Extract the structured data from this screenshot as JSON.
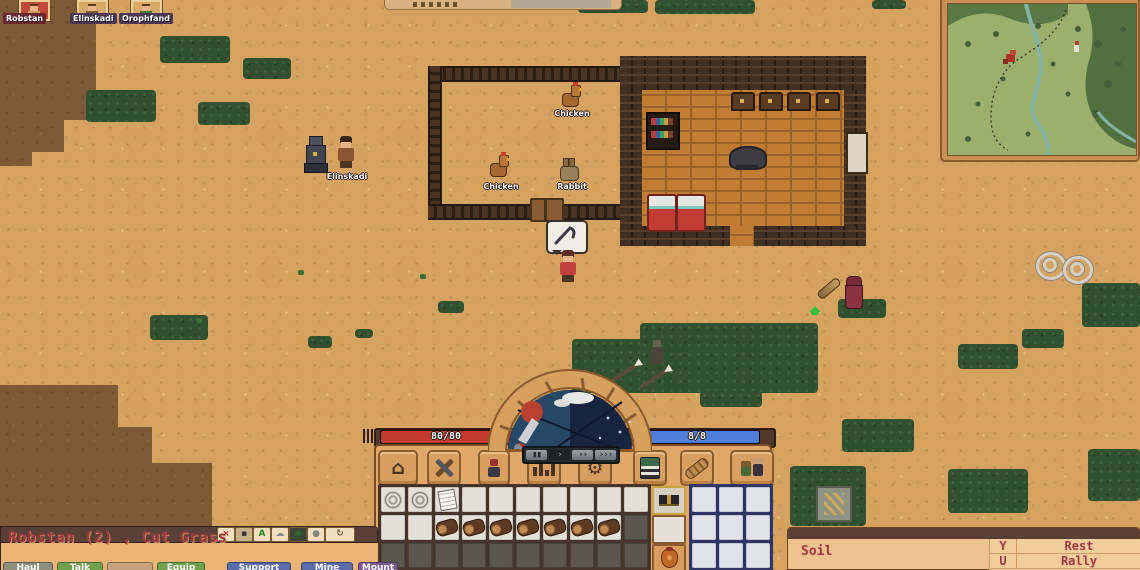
{
  "party": {
    "members": [
      {
        "name": "Robstan",
        "selected": true
      },
      {
        "name": "Elinskadi",
        "selected": false
      },
      {
        "name": "Orophfand",
        "selected": false
      }
    ]
  },
  "world": {
    "units": [
      {
        "id": "chicken-1",
        "label": "Chicken"
      },
      {
        "id": "chicken-2",
        "label": "Chicken"
      },
      {
        "id": "rabbit",
        "label": "Rabbit"
      },
      {
        "id": "elinskadi",
        "label": "Elinskadi"
      }
    ]
  },
  "hud": {
    "health_bar": {
      "value": "80/80",
      "color": "#c23b2e"
    },
    "energy_bar": {
      "value": "8/8",
      "color": "#4f7fd9"
    },
    "speed_controls": [
      {
        "id": "pause",
        "glyph": "▮▮"
      },
      {
        "id": "play",
        "glyph": "›"
      },
      {
        "id": "fast",
        "glyph": "››"
      },
      {
        "id": "fastest",
        "glyph": "›››"
      }
    ],
    "toolbar": [
      {
        "id": "build",
        "icon": "build-icon",
        "glyph": "⌂"
      },
      {
        "id": "crafting",
        "icon": "crossed-tools-icon",
        "glyph": ""
      },
      {
        "id": "character",
        "icon": "character-icon",
        "glyph": ""
      },
      {
        "id": "stats",
        "icon": "bar-chart-icon",
        "glyph": ""
      },
      {
        "id": "settings",
        "icon": "gear-icon",
        "glyph": "⚙"
      },
      {
        "id": "journal",
        "icon": "book-icon",
        "glyph": ""
      },
      {
        "id": "bandage",
        "icon": "bandage-icon",
        "glyph": ""
      },
      {
        "id": "squad",
        "icon": "squad-icon",
        "glyph": ""
      }
    ]
  },
  "inventory": {
    "main_grid": [
      [
        "rope",
        "rope",
        "scroll",
        "",
        "",
        "",
        "",
        "",
        "",
        ""
      ],
      [
        "",
        "",
        "log",
        "log",
        "log",
        "log",
        "log",
        "log",
        "log",
        "locked"
      ],
      [
        "locked",
        "locked",
        "locked",
        "locked",
        "locked",
        "locked",
        "locked",
        "locked",
        "locked",
        "locked"
      ]
    ],
    "equipment": [
      "goggles",
      "",
      "pot"
    ],
    "side_grid": [
      [
        "",
        "",
        ""
      ],
      [
        "",
        "",
        ""
      ],
      [
        "",
        "",
        ""
      ]
    ]
  },
  "selection_panel": {
    "title": "Robstan (2) , Cut Grass",
    "header_buttons": [
      {
        "id": "close",
        "glyph": "×",
        "fg": "#cc2020",
        "bg": "#f0e0c0"
      },
      {
        "id": "portrait",
        "glyph": "▪",
        "fg": "#3a3a3a",
        "bg": "#c8b088"
      },
      {
        "id": "auto",
        "glyph": "A",
        "fg": "#2a8a2a",
        "bg": "#f0e8d0"
      },
      {
        "id": "cloud",
        "glyph": "☁",
        "fg": "#8a8a92",
        "bg": "#e8d8b8"
      },
      {
        "id": "camera",
        "glyph": "◉",
        "fg": "#2a6a2a",
        "bg": "#3a4438"
      },
      {
        "id": "rock",
        "glyph": "●",
        "fg": "#8a857a",
        "bg": "#e8d8b8"
      },
      {
        "id": "refresh",
        "glyph": "↻",
        "fg": "#6a5a40",
        "bg": "#f0e4c8"
      }
    ],
    "command_tabs": [
      {
        "label": "Haul",
        "color": "#8f8f7d"
      },
      {
        "label": "Talk",
        "color": "#6fa14d"
      },
      {
        "label": "",
        "color": "#c4a37e"
      },
      {
        "label": "Equip",
        "color": "#6fa14d"
      },
      {
        "label": "Support",
        "color": "#5c6cab"
      },
      {
        "label": "Mine",
        "color": "#5c6cab"
      },
      {
        "label": "Mount",
        "color": "#7c5a96"
      }
    ]
  },
  "info_panel": {
    "title": "Soil"
  },
  "keybinds": [
    {
      "key": "Y",
      "action": "Rest"
    },
    {
      "key": "U",
      "action": "Rally"
    }
  ]
}
